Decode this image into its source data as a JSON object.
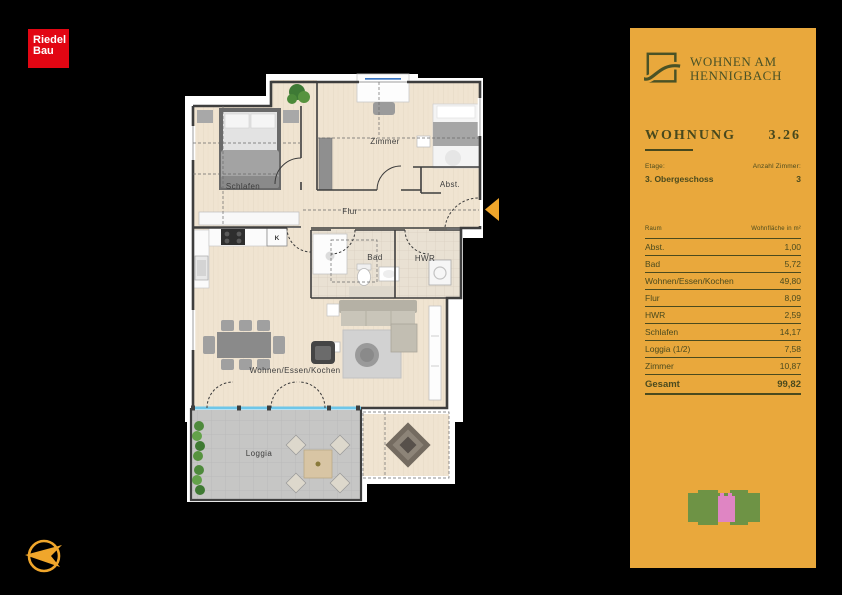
{
  "colors": {
    "background": "#000000",
    "panel_bg": "#e9a83c",
    "brand_green": "#4a5226",
    "riedel_red": "#e20613",
    "accent_orange": "#f0a62b",
    "siteplan_building": "#6e9345",
    "siteplan_unit": "#df85c3"
  },
  "riedel_logo": {
    "line1": "Riedel",
    "line2": "Bau"
  },
  "plan": {
    "rooms": [
      {
        "id": "schlafen",
        "label": "Schlafen"
      },
      {
        "id": "zimmer",
        "label": "Zimmer"
      },
      {
        "id": "abst",
        "label": "Abst."
      },
      {
        "id": "flur",
        "label": "Flur"
      },
      {
        "id": "bad",
        "label": "Bad"
      },
      {
        "id": "hwr",
        "label": "HWR"
      },
      {
        "id": "wohnen",
        "label": "Wohnen/Essen/Kochen"
      },
      {
        "id": "loggia",
        "label": "Loggia"
      }
    ],
    "kitchen_marker": "K"
  },
  "panel": {
    "project": {
      "line1": "WOHNEN AM",
      "line2": "HENNIGBACH"
    },
    "heading": {
      "label": "WOHNUNG",
      "number": "3.26"
    },
    "meta": {
      "etage_label": "Etage:",
      "etage_value": "3. Obergeschoss",
      "zimmer_label": "Anzahl Zimmer:",
      "zimmer_value": "3"
    },
    "table": {
      "col_room": "Raum",
      "col_area": "Wohnfläche in m²",
      "rows": [
        {
          "room": "Abst.",
          "area": "1,00"
        },
        {
          "room": "Bad",
          "area": "5,72"
        },
        {
          "room": "Wohnen/Essen/Kochen",
          "area": "49,80"
        },
        {
          "room": "Flur",
          "area": "8,09"
        },
        {
          "room": "HWR",
          "area": "2,59"
        },
        {
          "room": "Schlafen",
          "area": "14,17"
        },
        {
          "room": "Loggia (1/2)",
          "area": "7,58"
        },
        {
          "room": "Zimmer",
          "area": "10,87"
        }
      ],
      "total_label": "Gesamt",
      "total_value": "99,82"
    }
  }
}
